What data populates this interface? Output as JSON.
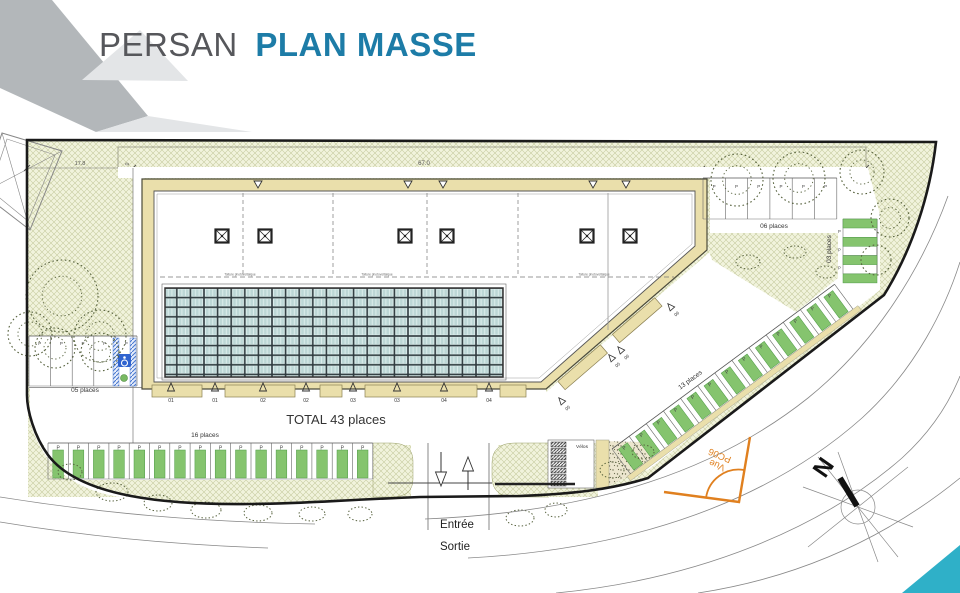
{
  "header": {
    "title_primary": "PERSAN",
    "title_secondary": "PLAN MASSE",
    "accent_color": "#1d7ca7",
    "corner_dark": "#b3b7ba",
    "corner_pale": "#e3e5e7"
  },
  "plan": {
    "total_label": "TOTAL 43 places",
    "stall_marker": "P",
    "labels": {
      "velos": "Vélos",
      "entree": "Entrée",
      "sortie": "Sortie",
      "vue": "Vue",
      "vue_ref": "PC06",
      "north": "N"
    },
    "dimensions": {
      "width_left": "17.8",
      "width_main": "67.0",
      "strip": "6.0"
    },
    "roof_note": "Toiture photovoltaïque",
    "dock_markers": [
      "01",
      "01",
      "02",
      "02",
      "03",
      "03",
      "04",
      "04"
    ],
    "dock_marker_xs": [
      171,
      215,
      263,
      306,
      353,
      397,
      444,
      489
    ],
    "dock_rects": [
      [
        152,
        50
      ],
      [
        225,
        70
      ],
      [
        320,
        22
      ],
      [
        365,
        112
      ],
      [
        500,
        26
      ]
    ],
    "ramp_markers": [
      {
        "x": 4,
        "t": "05"
      },
      {
        "x": 70,
        "t": "05"
      },
      {
        "x": 82,
        "t": "06"
      },
      {
        "x": 148,
        "t": "06"
      }
    ],
    "parking_groups": [
      {
        "id": "p16",
        "label": "16 places",
        "count": 16,
        "x": 48,
        "y": 443,
        "angle": 0,
        "pitch": 20.3,
        "depth": 36,
        "green": true,
        "bar": [
          4.8,
          7,
          10.7,
          28
        ],
        "p_y": 6.4,
        "p_size": 5,
        "label_pos": [
          157,
          -6
        ]
      },
      {
        "id": "p13",
        "label": "13 places",
        "count": 13,
        "x": 612,
        "y": 449,
        "angle": -36.5,
        "pitch": 21.3,
        "depth": 31,
        "green": true,
        "bar": [
          5,
          4,
          11,
          26
        ],
        "p_y": 8,
        "p_size": 5,
        "label_pos": [
          104,
          -7
        ],
        "tan_strip": true
      },
      {
        "id": "p05",
        "label": "05 places",
        "count": 5,
        "x": 29,
        "y": 336,
        "angle": 0,
        "pitch": 21.6,
        "depth": 50,
        "green": false,
        "p_y": 9,
        "p_size": 4.5,
        "label_pos": [
          56,
          56
        ]
      },
      {
        "id": "p06",
        "label": "06 places",
        "count": 6,
        "x": 703,
        "y": 178,
        "angle": 0,
        "pitch": 22.3,
        "depth": 41,
        "green": false,
        "p_y": 10,
        "p_size": 4.5,
        "label_pos": [
          71,
          50
        ]
      },
      {
        "id": "p03",
        "label": "03 places",
        "count": 3,
        "x": 877,
        "y": 219,
        "angle": 90,
        "pitch": 18.3,
        "depth": 34,
        "green": true,
        "vertical": true,
        "bar": [
          0,
          0,
          9,
          34
        ],
        "p_size": 4.2,
        "label_pos": [
          831,
          249
        ]
      }
    ],
    "columns_x": [
      222,
      265,
      405,
      447,
      587,
      630
    ],
    "gridlines_x": [
      243,
      333,
      427,
      518
    ],
    "wall_x": 608,
    "band_triangles_x": [
      258,
      408,
      443,
      593,
      626
    ],
    "roof_note_xs": [
      240,
      377,
      594
    ],
    "velos_rack_count": 7,
    "trees": [
      [
        62,
        296,
        36
      ],
      [
        100,
        336,
        26
      ],
      [
        30,
        334,
        22
      ],
      [
        55,
        348,
        20
      ],
      [
        100,
        352,
        19
      ],
      [
        737,
        180,
        26
      ],
      [
        799,
        178,
        26
      ],
      [
        862,
        172,
        22
      ],
      [
        890,
        218,
        19
      ],
      [
        876,
        260,
        15
      ]
    ],
    "shrubs": [
      [
        112,
        492,
        16,
        9
      ],
      [
        158,
        503,
        14,
        8
      ],
      [
        206,
        510,
        15,
        8
      ],
      [
        258,
        513,
        14,
        8
      ],
      [
        312,
        514,
        13,
        7
      ],
      [
        360,
        514,
        12,
        7
      ],
      [
        70,
        472,
        12,
        8
      ],
      [
        520,
        518,
        14,
        8
      ],
      [
        556,
        510,
        11,
        7
      ],
      [
        612,
        470,
        12,
        8
      ],
      [
        643,
        452,
        11,
        7
      ],
      [
        748,
        262,
        12,
        7
      ],
      [
        795,
        252,
        11,
        6
      ],
      [
        826,
        272,
        10,
        6
      ]
    ],
    "roads": [
      "M 0,497 C 100,513 200,522 315,524",
      "M 0,522 C 90,537 180,545 268,548",
      "M 425,519 C 600,512 720,468 808,398 C 876,343 922,268 948,196",
      "M 468,558 C 640,549 772,498 862,418 C 917,368 946,306 960,262",
      "M 556,593 C 700,579 822,528 902,458 C 936,427 952,396 960,376",
      "M 698,593 C 790,579 880,543 960,478"
    ],
    "colors": {
      "hatch_bg": "#f1f3dc",
      "hatch_line": "#c6ca9e",
      "tan": "#eadfab",
      "stall_green": "#85c46e",
      "stall_green_edge": "#4e9a46",
      "boundary": "#1a1a1a",
      "orange": "#e0801f",
      "teal_corner": "#2fb0c8",
      "handicap_blue": "#2f63cf"
    }
  }
}
